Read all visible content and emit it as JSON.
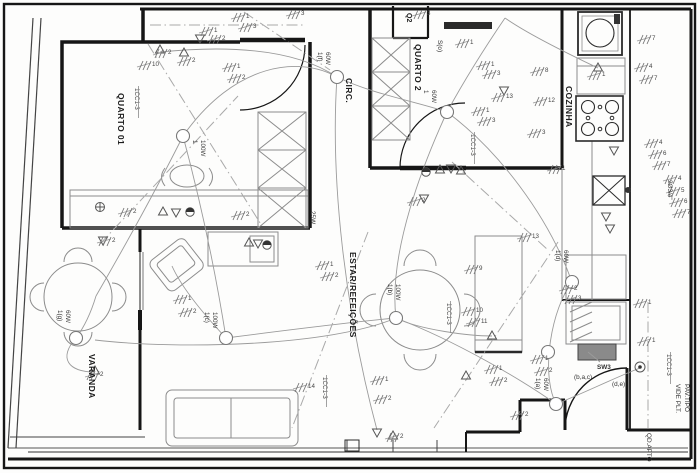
{
  "drawing": {
    "palette": {
      "ink": "#1c1c1c",
      "secondary": "#8c8c8c",
      "paper": "#fdfdfc",
      "panel_fill": "#8a8a8a"
    },
    "rooms": {
      "quarto01": "QUARTO 01",
      "quarto2": "QUARTO 2",
      "circ": "CIRC.",
      "cozinha": "COZINHA",
      "estar": "ESTAR/REFEIÇÕES",
      "varanda": "VARANDA"
    },
    "closet_tag": "Q2",
    "annotations": {
      "switch_o": "S(o)",
      "wardrobe_watt": "25W",
      "conduit": "2Ø3/4\"",
      "switch_group": "SW3",
      "switch_keys1": "(b,a,c)",
      "switch_keys2": "(d,e)",
      "see_plan_1": "VIDE PLT.",
      "see_plan_2": "PAV.TIPO",
      "panel": "QD.APTO"
    },
    "circuit_ref": "1CC1-3",
    "circuit_ref_positions": [
      {
        "x": 135,
        "y": 88
      },
      {
        "x": 471,
        "y": 134
      },
      {
        "x": 447,
        "y": 303
      },
      {
        "x": 323,
        "y": 377
      },
      {
        "x": 667,
        "y": 354
      }
    ],
    "lights": [
      {
        "tag": "1",
        "watt": "100W",
        "x": 183,
        "y": 136,
        "lx": 193,
        "ly": 140
      },
      {
        "tag": "1(f)",
        "watt": "60W",
        "x": 337,
        "y": 77,
        "lx": 318,
        "ly": 52
      },
      {
        "tag": "1",
        "watt": "60W",
        "x": 447,
        "y": 112,
        "lx": 424,
        "ly": 90
      },
      {
        "tag": "1(c)",
        "watt": "100W",
        "x": 226,
        "y": 338,
        "lx": 205,
        "ly": 312
      },
      {
        "tag": "1(b)",
        "watt": "100W",
        "x": 396,
        "y": 318,
        "lx": 388,
        "ly": 284
      },
      {
        "tag": "1(g)",
        "watt": "60W",
        "x": 76,
        "y": 338,
        "lx": 58,
        "ly": 310
      },
      {
        "tag": "1(d)",
        "watt": "60W",
        "x": 572,
        "y": 282,
        "lx": 556,
        "ly": 250
      },
      {
        "tag": "1(a)",
        "watt": "60W",
        "x": 556,
        "y": 404,
        "lx": 536,
        "ly": 378
      },
      {
        "tag": "",
        "watt": "",
        "x": 548,
        "y": 352,
        "lx": 0,
        "ly": 0
      }
    ],
    "wire_counts": [
      {
        "t": "2",
        "x": 166,
        "y": 50
      },
      {
        "t": "10",
        "x": 150,
        "y": 62
      },
      {
        "t": "2",
        "x": 190,
        "y": 58
      },
      {
        "t": "1",
        "x": 212,
        "y": 28
      },
      {
        "t": "2",
        "x": 220,
        "y": 36
      },
      {
        "t": "1",
        "x": 244,
        "y": 14
      },
      {
        "t": "3",
        "x": 251,
        "y": 24
      },
      {
        "t": "3",
        "x": 299,
        "y": 11
      },
      {
        "t": "1",
        "x": 235,
        "y": 64
      },
      {
        "t": "2",
        "x": 240,
        "y": 75
      },
      {
        "t": "3",
        "x": 425,
        "y": 11
      },
      {
        "t": "1",
        "x": 468,
        "y": 40
      },
      {
        "t": "1",
        "x": 489,
        "y": 62
      },
      {
        "t": "3",
        "x": 495,
        "y": 71
      },
      {
        "t": "8",
        "x": 543,
        "y": 68
      },
      {
        "t": "12",
        "x": 546,
        "y": 98
      },
      {
        "t": "13",
        "x": 504,
        "y": 94
      },
      {
        "t": "1",
        "x": 484,
        "y": 108
      },
      {
        "t": "3",
        "x": 490,
        "y": 118
      },
      {
        "t": "7",
        "x": 650,
        "y": 36
      },
      {
        "t": "4",
        "x": 647,
        "y": 64
      },
      {
        "t": "7",
        "x": 652,
        "y": 76
      },
      {
        "t": "4",
        "x": 657,
        "y": 140
      },
      {
        "t": "6",
        "x": 661,
        "y": 151
      },
      {
        "t": "7",
        "x": 665,
        "y": 162
      },
      {
        "t": "4",
        "x": 676,
        "y": 176
      },
      {
        "t": "5",
        "x": 679,
        "y": 188
      },
      {
        "t": "6",
        "x": 682,
        "y": 199
      },
      {
        "t": "7",
        "x": 685,
        "y": 210
      },
      {
        "t": "2",
        "x": 131,
        "y": 209
      },
      {
        "t": "2",
        "x": 110,
        "y": 238
      },
      {
        "t": "1",
        "x": 328,
        "y": 262
      },
      {
        "t": "2",
        "x": 333,
        "y": 273
      },
      {
        "t": "1",
        "x": 186,
        "y": 296
      },
      {
        "t": "2",
        "x": 191,
        "y": 309
      },
      {
        "t": "2",
        "x": 244,
        "y": 212
      },
      {
        "t": "9",
        "x": 477,
        "y": 266
      },
      {
        "t": "10",
        "x": 474,
        "y": 308
      },
      {
        "t": "11",
        "x": 479,
        "y": 319
      },
      {
        "t": "13",
        "x": 530,
        "y": 234
      },
      {
        "t": "14",
        "x": 306,
        "y": 384
      },
      {
        "t": "1",
        "x": 383,
        "y": 377
      },
      {
        "t": "2",
        "x": 386,
        "y": 396
      },
      {
        "t": "2",
        "x": 398,
        "y": 434
      },
      {
        "t": "1",
        "x": 497,
        "y": 366
      },
      {
        "t": "2",
        "x": 502,
        "y": 378
      },
      {
        "t": "1",
        "x": 543,
        "y": 356
      },
      {
        "t": "2",
        "x": 547,
        "y": 368
      },
      {
        "t": "2",
        "x": 523,
        "y": 412
      },
      {
        "t": "1",
        "x": 646,
        "y": 300
      },
      {
        "t": "1",
        "x": 650,
        "y": 338
      },
      {
        "t": "2",
        "x": 572,
        "y": 286
      },
      {
        "t": "3",
        "x": 576,
        "y": 296
      },
      {
        "t": "2",
        "x": 420,
        "y": 198
      },
      {
        "t": "1",
        "x": 560,
        "y": 166
      },
      {
        "t": "2",
        "x": 98,
        "y": 372
      },
      {
        "t": "1",
        "x": 600,
        "y": 72
      },
      {
        "t": "3",
        "x": 540,
        "y": 130
      }
    ],
    "outlets": [
      {
        "x": 160,
        "y": 50,
        "d": "u"
      },
      {
        "x": 184,
        "y": 53,
        "d": "u"
      },
      {
        "x": 163,
        "y": 212,
        "d": "u"
      },
      {
        "x": 176,
        "y": 212,
        "d": "d"
      },
      {
        "x": 103,
        "y": 240,
        "d": "d"
      },
      {
        "x": 249,
        "y": 243,
        "d": "u"
      },
      {
        "x": 258,
        "y": 243,
        "d": "d"
      },
      {
        "x": 440,
        "y": 170,
        "d": "u"
      },
      {
        "x": 451,
        "y": 168,
        "d": "d"
      },
      {
        "x": 461,
        "y": 171,
        "d": "u"
      },
      {
        "x": 424,
        "y": 198,
        "d": "d"
      },
      {
        "x": 598,
        "y": 68,
        "d": "u"
      },
      {
        "x": 614,
        "y": 150,
        "d": "d"
      },
      {
        "x": 606,
        "y": 216,
        "d": "d"
      },
      {
        "x": 610,
        "y": 228,
        "d": "d"
      },
      {
        "x": 504,
        "y": 90,
        "d": "d"
      },
      {
        "x": 95,
        "y": 371,
        "d": "u"
      },
      {
        "x": 377,
        "y": 432,
        "d": "d",
        "f": 1
      },
      {
        "x": 393,
        "y": 436,
        "d": "u"
      },
      {
        "x": 492,
        "y": 336,
        "d": "u"
      },
      {
        "x": 466,
        "y": 376,
        "d": "u"
      },
      {
        "x": 200,
        "y": 38,
        "d": "d"
      }
    ],
    "symbols": {
      "half_circles": [
        [
          190,
          212
        ],
        [
          267,
          245
        ],
        [
          426,
          172
        ]
      ],
      "cross_circles": [
        [
          100,
          207
        ]
      ],
      "bell": [
        640,
        367
      ]
    }
  }
}
